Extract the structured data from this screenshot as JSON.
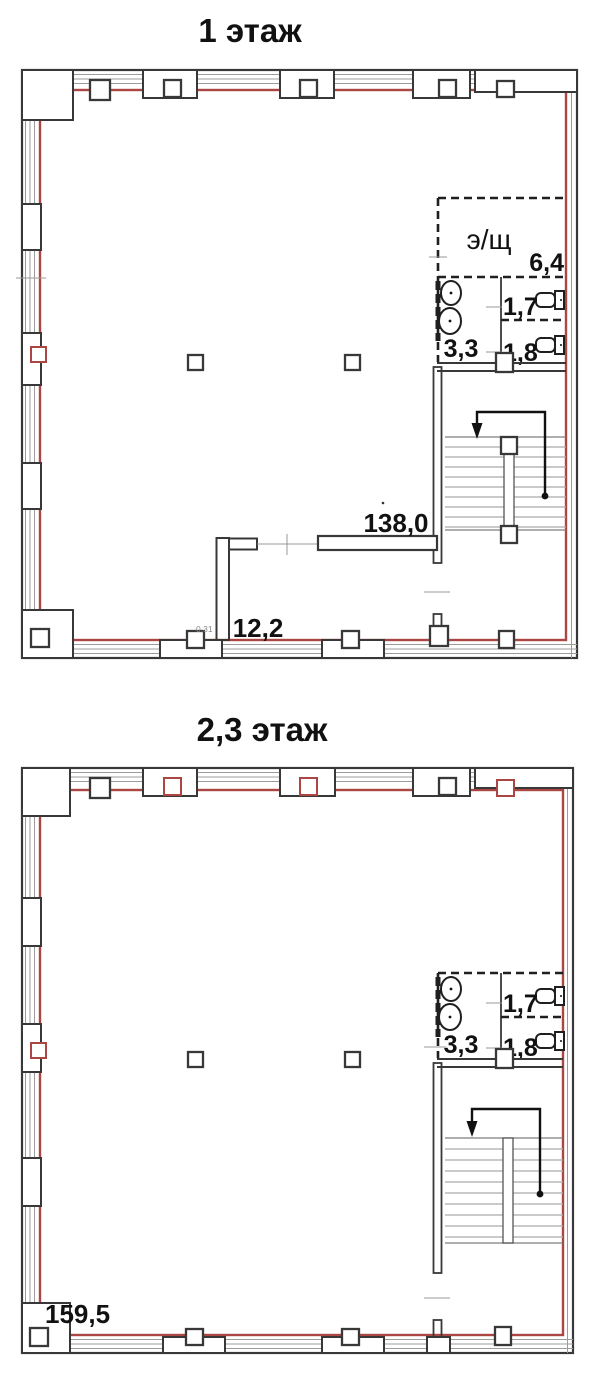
{
  "document": {
    "type": "building floor plan drawing",
    "background": "#ffffff"
  },
  "colors": {
    "wall_outline": "#383838",
    "red_layout_line": "#ab4642",
    "window_line": "#9c9c9c",
    "stair_tread": "#ababab",
    "text": "#111111"
  },
  "floor1": {
    "title": "1 этаж",
    "wall_dim": "0.31",
    "rooms": {
      "electrical": {
        "label": "э/щ",
        "area": "6,4"
      },
      "wc_small": {
        "area": "1,7"
      },
      "washroom": {
        "area": "3,3"
      },
      "wc_large": {
        "area": "1,8"
      },
      "main_hall": {
        "area": "138,0"
      },
      "corridor": {
        "area": "12,2"
      }
    }
  },
  "floor2": {
    "title": "2,3 этаж",
    "rooms": {
      "wc_small": {
        "area": "1,7"
      },
      "washroom": {
        "area": "3,3"
      },
      "wc_large": {
        "area": "1,8"
      },
      "main_hall": {
        "area": "159,5"
      }
    }
  }
}
